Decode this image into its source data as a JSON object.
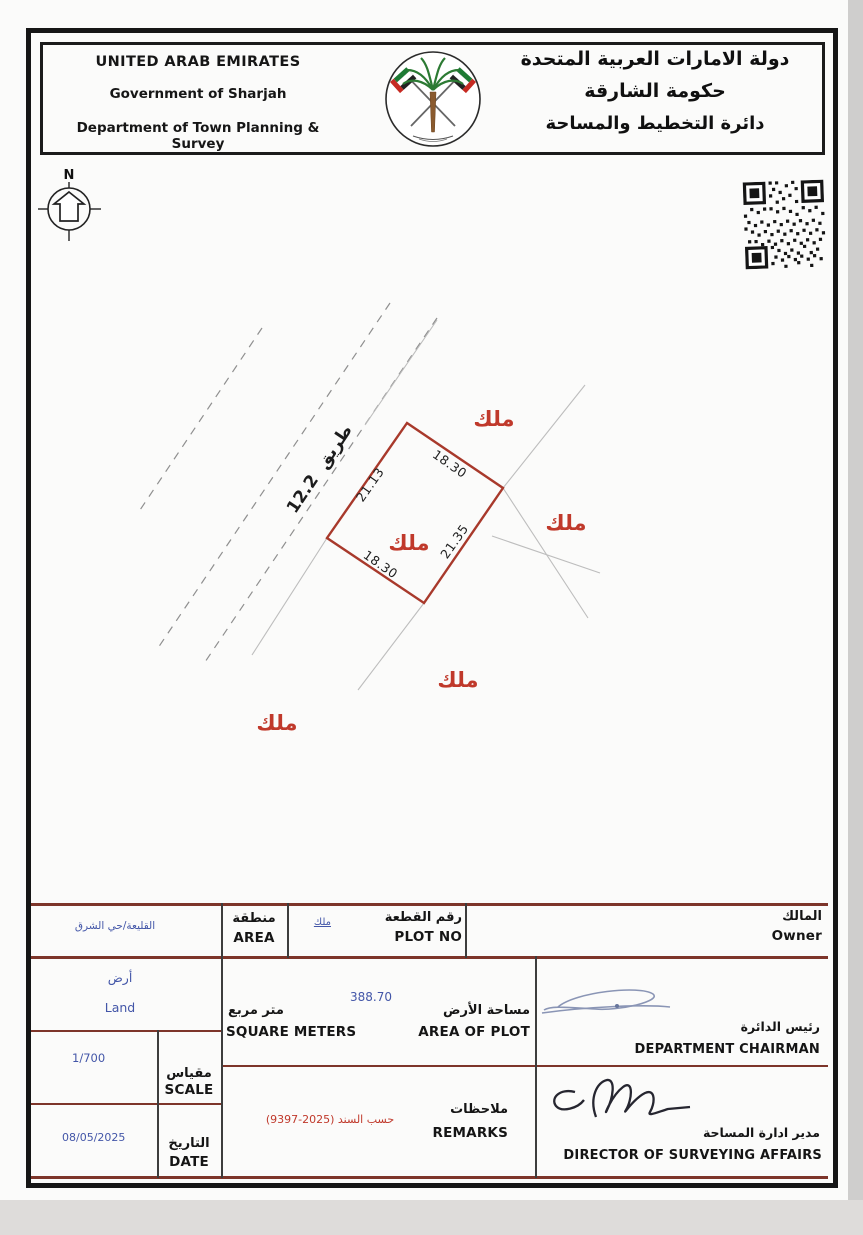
{
  "header": {
    "en_line1": "UNITED ARAB EMIRATES",
    "en_line2": "Government of Sharjah",
    "en_line3": "Department of Town Planning & Survey",
    "ar_line1": "دولة الامارات العربية المتحدة",
    "ar_line2": "حكومة الشارقة",
    "ar_line3": "دائرة التخطيط والمساحة",
    "emblem_icon": "uae-crossed-flags-palm-emblem",
    "stamp_icon": "qr-code-stamp"
  },
  "compass": {
    "north_label": "N"
  },
  "drawing": {
    "road_label": "طريق 12.2",
    "plot": {
      "owner_label": "ملك",
      "dim_top": "18.30",
      "dim_left": "21.13",
      "dim_right": "21.35",
      "dim_bottom": "18.30"
    },
    "neighbors": {
      "top": "ملك",
      "right": "ملك",
      "bottom": "ملك",
      "bottom_left": "ملك"
    }
  },
  "table": {
    "owner": {
      "label_ar": "المالك",
      "label_en": "Owner"
    },
    "plot_no": {
      "label_ar": "رقم القطعة",
      "label_en": "PLOT NO",
      "value": "ملك"
    },
    "area": {
      "label_ar": "منطقة",
      "label_en": "AREA",
      "value": "القليعة/حي الشرق"
    },
    "land_type": {
      "value_ar": "أرض",
      "value_en": "Land"
    },
    "area_of_plot": {
      "label_ar": "مساحة الأرض",
      "label_en": "AREA OF PLOT",
      "unit_ar": "متر مربع",
      "unit_en": "SQUARE METERS",
      "value": "388.70"
    },
    "scale": {
      "label_ar": "مقياس",
      "label_en": "SCALE",
      "value": "1/700"
    },
    "date": {
      "label_ar": "التاريخ",
      "label_en": "DATE",
      "value": "08/05/2025"
    },
    "remarks": {
      "label_ar": "ملاحظات",
      "label_en": "REMARKS",
      "value": "حسب السند (2025-9397)"
    },
    "chairman": {
      "label_ar": "رئيس الدائرة",
      "label_en": "DEPARTMENT CHAIRMAN"
    },
    "director": {
      "label_ar": "مدير ادارة المساحة",
      "label_en": "DIRECTOR OF SURVEYING AFFAIRS"
    }
  },
  "colors": {
    "plot_outline": "#a8392b",
    "value_blue": "#4356a8",
    "remark_red": "#c0392b",
    "table_line": "#7d352a"
  }
}
